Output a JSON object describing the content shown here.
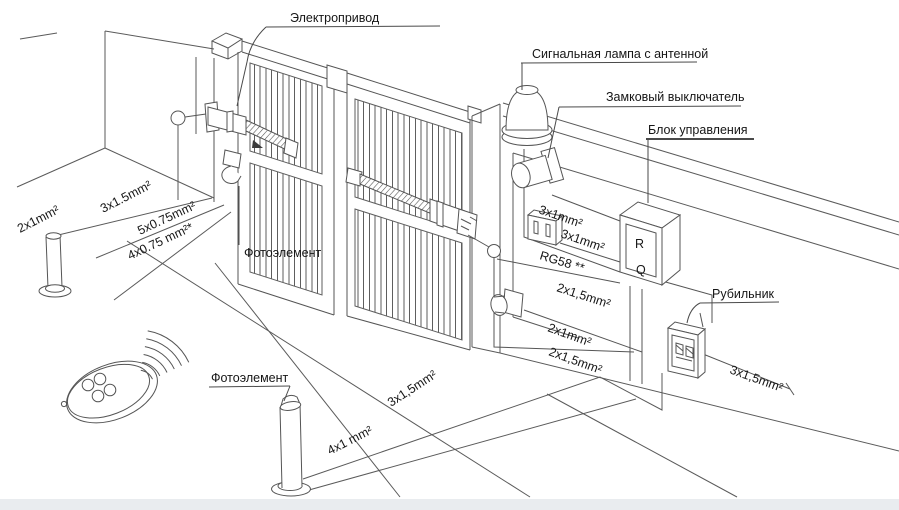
{
  "callouts": {
    "electric_drive": "Электропривод",
    "signal_lamp": "Сигнальная лампа с антенной",
    "lock_switch": "Замковый выключатель",
    "control_unit": "Блок управления",
    "photocell_gate": "Фотоэлемент",
    "photocell_ground": "Фотоэлемент",
    "knife_switch": "Рубильник"
  },
  "cable_labels": {
    "left_photocell_post": "2x1mm²",
    "left_main_line": "3x1.5mm²",
    "drive_control_5core": "5x0.75mm²",
    "drive_control_4core": "4x0.75 mm²*",
    "signal_lamp_cable": "3x1mm²",
    "lock_switch_cable": "3x1mm²",
    "antenna_coax": "RG58 **",
    "right_drive_cable": "2x1,5mm²",
    "right_photocell_cable": "2x1mm²",
    "left_drive_cable": "2x1,5mm²",
    "mains_cable": "3x1,5mm²",
    "ground_photocell_cable": "4x1 mm²",
    "ground_main_cable": "3x1,5mm²"
  },
  "control_unit_box": {
    "letter_top": "R",
    "letter_bottom": "Q"
  },
  "colors": {
    "line": "#555555",
    "text": "#161616",
    "ground_strip": "#e9ecef"
  }
}
